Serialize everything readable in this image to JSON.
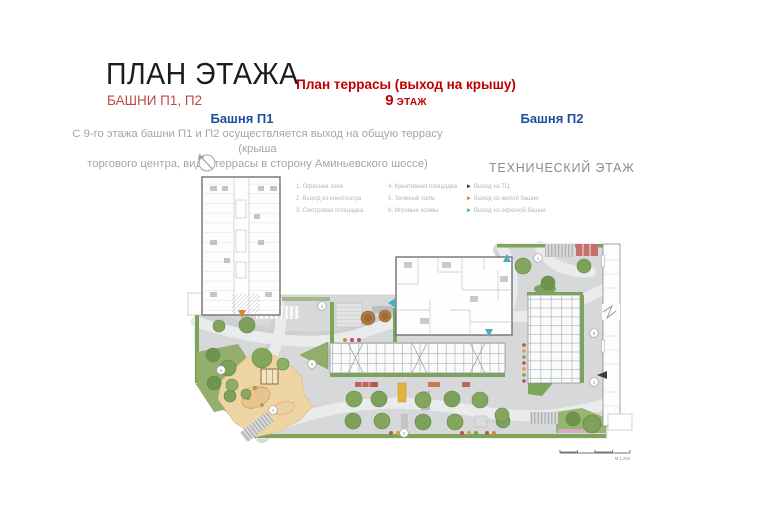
{
  "slide": {
    "title": "ПЛАН ЭТАЖА",
    "subtitle": "БАШНИ П1, П2",
    "terrace_heading": "План террасы (выход на крышу)",
    "floor_number": "9",
    "floor_word": " ЭТАЖ",
    "tower1": "Башня П1",
    "tower2": "Башня П2",
    "description_line1": "С 9-го этажа башни П1 и П2 осуществляется выход на общую террасу (крыша",
    "description_line2": "торгового центра, вид с террасы  в сторону Аминьевского шоссе)",
    "technical_floor": "ТЕХНИЧЕСКИЙ ЭТАЖ"
  },
  "legend": {
    "col1": [
      "1. Офисная зона",
      "2. Выход из кинотеатра",
      "3. Смотровая площадка"
    ],
    "col2": [
      "4. Креативная площадка",
      "5. Зеленый холм",
      "6. Игровые холмы"
    ],
    "exits": [
      {
        "label": "Выход из ТЦ",
        "color": "#3f3f41"
      },
      {
        "label": "Выход из жилой башни",
        "color": "#e0813c"
      },
      {
        "label": "Выход из офисной башни",
        "color": "#4bacc6"
      }
    ]
  },
  "plan": {
    "markers": [
      "1",
      "2",
      "6",
      "3",
      "3",
      "6",
      "4",
      "5"
    ],
    "scale_label": "М 1:200"
  },
  "colors": {
    "title_text": "#1c1c1c",
    "accent_red": "#c00000",
    "subtitle_red": "#bb4a42",
    "tower_blue": "#1f4e9f",
    "muted_gray": "#a5a5a5",
    "terrace_gray": "#d7d8da",
    "greenery": "#83a65c",
    "sand": "#eed4a3",
    "exit_black": "#3f3f41",
    "exit_orange": "#e0813c",
    "exit_blue": "#4bacc6"
  }
}
